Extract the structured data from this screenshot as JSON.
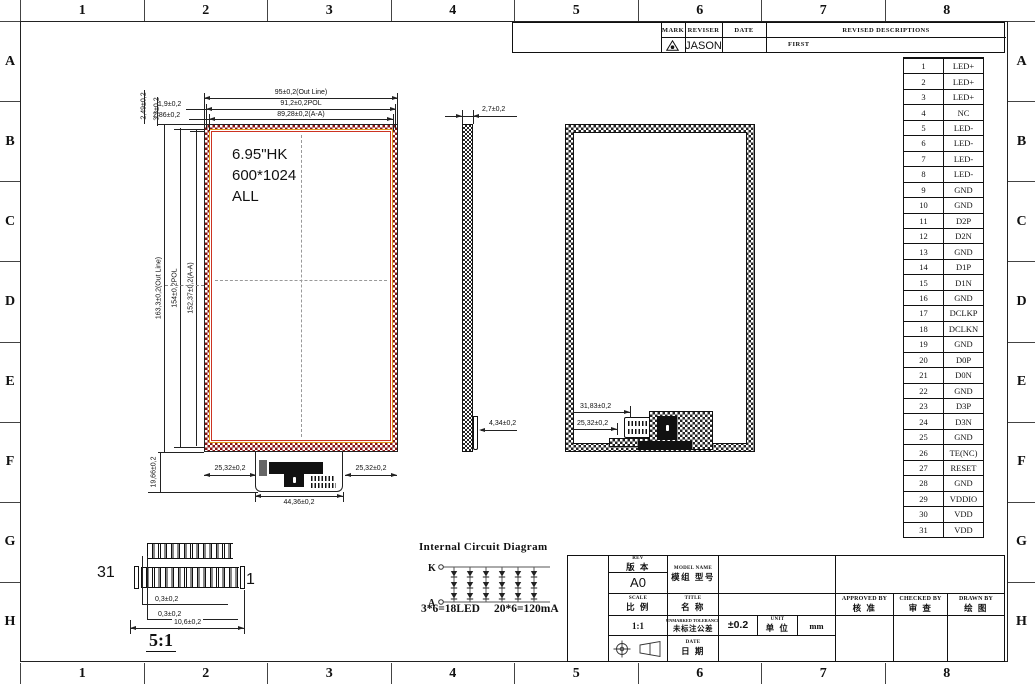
{
  "colors": {
    "outline_hatch": "#8a1414",
    "pol_line": "#e09a1a",
    "active_area_line": "#cc3322",
    "line": "#222222"
  },
  "grid": {
    "columns": [
      "1",
      "2",
      "3",
      "4",
      "5",
      "6",
      "7",
      "8"
    ],
    "rows": [
      "A",
      "B",
      "C",
      "D",
      "E",
      "F",
      "G",
      "H"
    ]
  },
  "revision_table": {
    "headers": {
      "mark": "MARK",
      "reviser": "REVISER",
      "date": "DATE",
      "description": "REVISED DESCRIPTIONS"
    },
    "rows": [
      {
        "mark_icon": "revision-triangle-icon",
        "reviser": "JASON",
        "date": "",
        "description": "FIRST"
      }
    ]
  },
  "pin_table": {
    "pins": [
      {
        "no": "1",
        "name": "LED+"
      },
      {
        "no": "2",
        "name": "LED+"
      },
      {
        "no": "3",
        "name": "LED+"
      },
      {
        "no": "4",
        "name": "NC"
      },
      {
        "no": "5",
        "name": "LED-"
      },
      {
        "no": "6",
        "name": "LED-"
      },
      {
        "no": "7",
        "name": "LED-"
      },
      {
        "no": "8",
        "name": "LED-"
      },
      {
        "no": "9",
        "name": "GND"
      },
      {
        "no": "10",
        "name": "GND"
      },
      {
        "no": "11",
        "name": "D2P"
      },
      {
        "no": "12",
        "name": "D2N"
      },
      {
        "no": "13",
        "name": "GND"
      },
      {
        "no": "14",
        "name": "D1P"
      },
      {
        "no": "15",
        "name": "D1N"
      },
      {
        "no": "16",
        "name": "GND"
      },
      {
        "no": "17",
        "name": "DCLKP"
      },
      {
        "no": "18",
        "name": "DCLKN"
      },
      {
        "no": "19",
        "name": "GND"
      },
      {
        "no": "20",
        "name": "D0P"
      },
      {
        "no": "21",
        "name": "D0N"
      },
      {
        "no": "22",
        "name": "GND"
      },
      {
        "no": "23",
        "name": "D3P"
      },
      {
        "no": "24",
        "name": "D3N"
      },
      {
        "no": "25",
        "name": "GND"
      },
      {
        "no": "26",
        "name": "TE(NC)"
      },
      {
        "no": "27",
        "name": "RESET"
      },
      {
        "no": "28",
        "name": "GND"
      },
      {
        "no": "29",
        "name": "VDDIO"
      },
      {
        "no": "30",
        "name": "VDD"
      },
      {
        "no": "31",
        "name": "VDD"
      }
    ]
  },
  "front_view": {
    "screen_label": [
      "6.95\"HK",
      "600*1024",
      "ALL"
    ],
    "dim_top": [
      "95±0,2(Out Line)",
      "91,2±0,2POL",
      "89,28±0,2(A-A)"
    ],
    "dim_top_left_h": [
      "1,9±0,2",
      "2,86±0,2"
    ],
    "dim_top_left_v": [
      "2,49±0,2",
      "3,3±0,2"
    ],
    "dim_left": [
      "163,3±0,2(Out Line)",
      "154±0,2POL",
      "152,37±0,2(A-A)"
    ],
    "dim_bottom_left": "25,32±0,2",
    "dim_bottom_right": "25,32±0,2",
    "dim_tab_width": "44,36±0,2",
    "dim_tab_height": "19,66±0,2"
  },
  "side_view": {
    "dim_thickness": "2,7±0,2",
    "dim_bottom": "4,34±0,2"
  },
  "back_view": {
    "dim_connector_offset1": "31,83±0,2",
    "dim_connector_offset2": "25,32±0,2"
  },
  "connector_detail": {
    "pin_left": "31",
    "pin_right": "1",
    "dim_pin1": "0,3±0,2",
    "dim_pin2": "0,3±0,2",
    "dim_width": "10,6±0,2",
    "scale": "5:1"
  },
  "circuit": {
    "title": "Internal Circuit Diagram",
    "cathode": "K",
    "anode": "A",
    "formula_led": "3*6=18LED",
    "formula_current": "20*6=120mA"
  },
  "title_block": {
    "rev_label": "REV",
    "rev_label_cn": "版 本",
    "rev_value": "A0",
    "model_label": "MODEL NAME",
    "model_label_cn": "模组 型号",
    "model_value": "",
    "scale_label": "SCALE",
    "scale_label_cn": "比 例",
    "scale_value": "1:1",
    "title_label": "TITLE",
    "title_label_cn": "名 称",
    "title_value": "",
    "tol_label": "UNMARKED TOLERANCE",
    "tol_label_cn": "未标注公差",
    "tol_value": "±0.2",
    "unit_label": "UNIT",
    "unit_label_cn": "单 位",
    "unit_value": "mm",
    "date_label": "DATE",
    "date_label_cn": "日 期",
    "date_value": "",
    "approved_label": "APPROVED BY",
    "approved_label_cn": "核 准",
    "checked_label": "CHECKED BY",
    "checked_label_cn": "审 查",
    "drawn_label": "DRAWN BY",
    "drawn_label_cn": "绘 图"
  }
}
